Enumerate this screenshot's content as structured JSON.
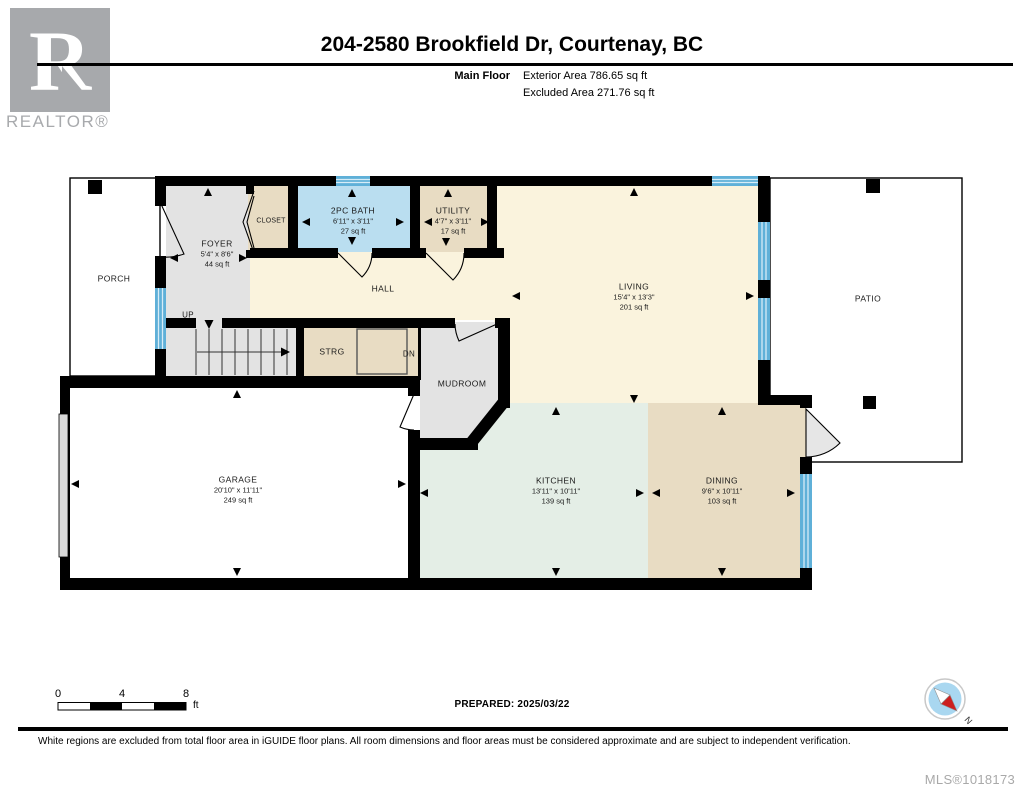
{
  "header": {
    "logo_letter": "R",
    "logo_text": "REALTOR®",
    "title": "204-2580 Brookfield Dr, Courtenay, BC",
    "floor_label": "Main Floor",
    "exterior_area": "Exterior Area 786.65 sq ft",
    "excluded_area": "Excluded Area 271.76 sq ft"
  },
  "rooms": {
    "porch": {
      "name": "PORCH"
    },
    "foyer": {
      "name": "FOYER",
      "dims": "5'4\" x 8'6\"",
      "area": "44 sq ft"
    },
    "closet": {
      "name": "CLOSET"
    },
    "bath": {
      "name": "2PC BATH",
      "dims": "6'11\" x 3'11\"",
      "area": "27 sq ft"
    },
    "utility": {
      "name": "UTILITY",
      "dims": "4'7\" x 3'11\"",
      "area": "17 sq ft"
    },
    "hall": {
      "name": "HALL"
    },
    "living": {
      "name": "LIVING",
      "dims": "15'4\" x 13'3\"",
      "area": "201 sq ft"
    },
    "patio": {
      "name": "PATIO"
    },
    "strg": {
      "name": "STRG"
    },
    "mudroom": {
      "name": "MUDROOM"
    },
    "garage": {
      "name": "GARAGE",
      "dims": "20'10\" x 11'11\"",
      "area": "249 sq ft"
    },
    "kitchen": {
      "name": "KITCHEN",
      "dims": "13'11\" x 10'11\"",
      "area": "139 sq ft"
    },
    "dining": {
      "name": "DINING",
      "dims": "9'6\" x 10'11\"",
      "area": "103 sq ft"
    }
  },
  "stairs": {
    "up": "UP",
    "down": "DN"
  },
  "scale_bar": {
    "t0": "0",
    "t4": "4",
    "t8": "8",
    "unit": "ft"
  },
  "prepared": "PREPARED: 2025/03/22",
  "compass": {
    "north": "N"
  },
  "footer": {
    "disclaimer": "White regions are excluded from total floor area in iGUIDE floor plans. All room dimensions and floor areas must be considered approximate and are subject to independent verification.",
    "mls": "MLS®1018173"
  },
  "colors": {
    "wall": "#000000",
    "window_blue": "#5fb0d8",
    "window_stripe": "#d6ecf7",
    "living_cream": "#faf3dd",
    "tan": "#e8dcc3",
    "gray_room": "#e3e3e3",
    "kitchen_mint": "#e4eee6",
    "bath_blue": "#badef0",
    "excluded_white": "#ffffff",
    "logo_gray": "#a7a9ac",
    "compass_blue": "#a9d7f0",
    "compass_red": "#cc1f1f"
  }
}
